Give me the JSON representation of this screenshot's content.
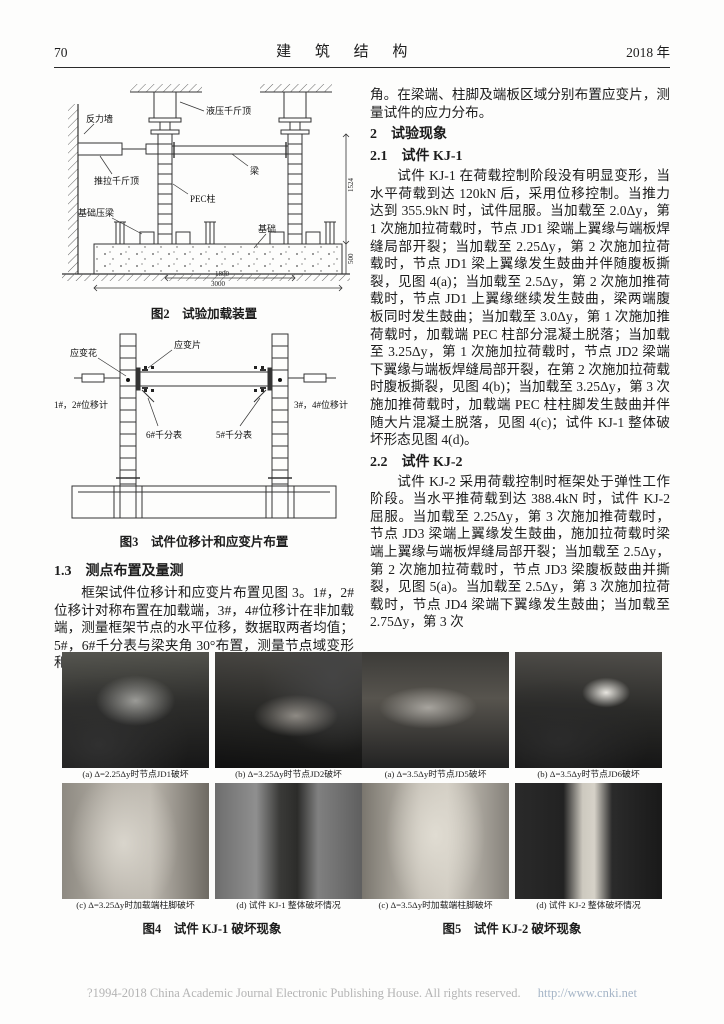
{
  "header": {
    "page_number": "70",
    "journal_title": "建 筑 结 构",
    "year": "2018 年"
  },
  "figure2": {
    "caption": "图2　试验加载装置",
    "labels": {
      "reaction_wall": "反力墙",
      "hydraulic_jack": "液压千斤顶",
      "push_pull_jack": "推拉千斤顶",
      "beam": "梁",
      "pec_column": "PEC柱",
      "foundation_press_beam": "基础压梁",
      "foundation": "基础",
      "dim_height": "1524",
      "dim_foundation": "500",
      "dim_span": "1800",
      "dim_total": "3000"
    }
  },
  "figure3": {
    "caption": "图3　试件位移计和应变片布置",
    "labels": {
      "strain_rosette": "应变花",
      "strain_gauge": "应变片",
      "disp_1_2": "1#，2#位移计",
      "dial_6": "6#千分表",
      "dial_5": "5#千分表",
      "disp_3_4": "3#，4#位移计"
    }
  },
  "section_1_3": {
    "heading": "1.3　测点布置及量测",
    "body": "框架试件位移计和应变片布置见图 3。1#，2# 位移计对称布置在加载端，3#，4#位移计在非加载端，测量框架节点的水平位移，数据取两者均值；5#，6#千分表与梁夹角 30°布置，测量节点域变形和转"
  },
  "right_column": {
    "para_continuation": "角。在梁端、柱脚及端板区域分别布置应变片，测量试件的应力分布。",
    "section2_heading": "2　试验现象",
    "section2_1_heading": "2.1　试件 KJ-1",
    "para_kj1": "试件 KJ-1 在荷载控制阶段没有明显变形，当水平荷载到达 120kN 后，采用位移控制。当推力达到 355.9kN 时，试件屈服。当加载至 2.0Δy，第 1 次施加拉荷载时，节点 JD1 梁端上翼缘与端板焊缝局部开裂；当加载至 2.25Δy，第 2 次施加拉荷载时，节点 JD1 梁上翼缘发生鼓曲并伴随腹板撕裂，见图 4(a)；当加载至 2.5Δy，第 2 次施加推荷载时，节点 JD1 上翼缘继续发生鼓曲，梁两端腹板同时发生鼓曲；当加载至 3.0Δy，第 1 次施加推荷载时，加载端 PEC 柱部分混凝土脱落；当加载至 3.25Δy，第 1 次施加拉荷载时，节点 JD2 梁端下翼缘与端板焊缝局部开裂，在第 2 次施加拉荷载时腹板撕裂，见图 4(b)；当加载至 3.25Δy，第 3 次施加推荷载时，加载端 PEC 柱柱脚发生鼓曲并伴随大片混凝土脱落，见图 4(c)；试件 KJ-1 整体破坏形态见图 4(d)。",
    "section2_2_heading": "2.2　试件 KJ-2",
    "para_kj2": "试件 KJ-2 采用荷载控制时框架处于弹性工作阶段。当水平推荷载到达 388.4kN 时，试件 KJ-2 屈服。当加载至 2.25Δy，第 3 次施加推荷载时，节点 JD3 梁端上翼缘发生鼓曲，施加拉荷载时梁端上翼缘与端板焊缝局部开裂；当加载至 2.5Δy，第 2 次施加拉荷载时，节点 JD3 梁腹板鼓曲并撕裂，见图 5(a)。当加载至 2.5Δy，第 3 次施加拉荷载时，节点 JD4 梁端下翼缘发生鼓曲；当加载至 2.75Δy，第 3 次"
  },
  "figure4": {
    "caption": "图4　试件 KJ-1 破坏现象",
    "photos": [
      {
        "caption": "(a) Δ=2.25Δy时节点JD1破坏"
      },
      {
        "caption": "(b) Δ=3.25Δy时节点JD2破坏"
      },
      {
        "caption": "(c) Δ=3.25Δy时加载端柱脚破坏"
      },
      {
        "caption": "(d) 试件 KJ-1 整体破坏情况"
      }
    ]
  },
  "figure5": {
    "caption": "图5　试件 KJ-2 破坏现象",
    "photos": [
      {
        "caption": "(a) Δ=3.5Δy时节点JD5破坏"
      },
      {
        "caption": "(b) Δ=3.5Δy时节点JD6破坏"
      },
      {
        "caption": "(c) Δ=3.5Δy时加载端柱脚破坏"
      },
      {
        "caption": "(d) 试件 KJ-2 整体破坏情况"
      }
    ]
  },
  "footer": {
    "copyright": "?1994-2018 China Academic Journal Electronic Publishing House. All rights reserved.",
    "url": "http://www.cnki.net"
  }
}
